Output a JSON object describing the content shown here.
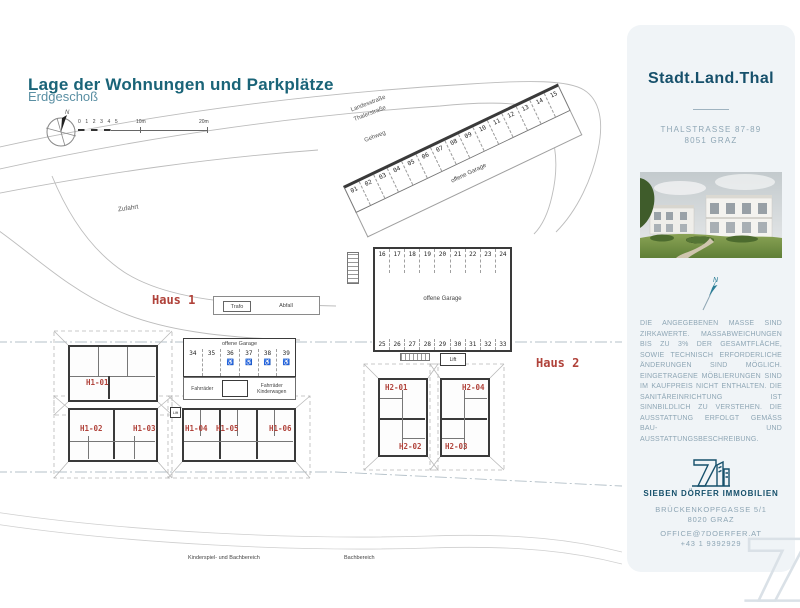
{
  "header": {
    "title": "Lage der Wohnungen und Parkplätze",
    "subtitle": "Erdgeschoß"
  },
  "map": {
    "compass_n": "N",
    "scale_ticks": "0 1 2 3 4 5",
    "scale_10": "10m",
    "scale_20": "20m",
    "road_label_1": "Landesstraße",
    "road_label_2": "Thalerstraße",
    "sidewalk_label": "Gehweg",
    "access_label": "Zufahrt",
    "wheelchair_icon": "♿",
    "strip": {
      "label": "offene Garage",
      "stalls": [
        "01",
        "02",
        "03",
        "04",
        "05",
        "06",
        "07",
        "08",
        "09",
        "10",
        "11",
        "12",
        "13",
        "14",
        "15"
      ]
    },
    "garage": {
      "label": "offene Garage",
      "top": [
        "16",
        "17",
        "18",
        "19",
        "20",
        "21",
        "22",
        "23",
        "24"
      ],
      "bottom": [
        "25",
        "26",
        "27",
        "28",
        "29",
        "30",
        "31",
        "32",
        "33"
      ],
      "lift": "Lift"
    },
    "haus1_garage": {
      "label": "offene Garage",
      "stalls": [
        {
          "n": "34",
          "acc": false
        },
        {
          "n": "35",
          "acc": false
        },
        {
          "n": "36",
          "acc": true
        },
        {
          "n": "37",
          "acc": true
        },
        {
          "n": "38",
          "acc": true
        },
        {
          "n": "39",
          "acc": true
        }
      ],
      "trafo": "Trafo",
      "waste": "Abfall",
      "bikes_left": "Fahrräder",
      "bikes_right_1": "Fahrräder",
      "bikes_right_2": "Kinderwagen",
      "lift": "Lift"
    },
    "haus1": {
      "label": "Haus 1",
      "units": [
        "H1-01",
        "H1-02",
        "H1-03",
        "H1-04",
        "H1-05",
        "H1-06"
      ]
    },
    "haus2": {
      "label": "Haus 2",
      "units": [
        "H2-01",
        "H2-02",
        "H2-03",
        "H2-04"
      ]
    },
    "area_label_left": "Kinderspiel- und Bachbereich",
    "area_label_right": "Bachbereich"
  },
  "sidebar": {
    "brand": "Stadt.Land.Thal",
    "address_line1": "THALSTRASSE 87-89",
    "address_line2": "8051 GRAZ",
    "disclaimer": "DIE ANGEGEBENEN MASSE SIND ZIRKAWERTE. MASSABWEICHUNGEN BIS ZU 3% DER GESAMTFLÄCHE, SOWIE TECHNISCH ERFORDERLICHE ÄNDERUNGEN SIND MÖGLICH. EINGETRAGENE MÖBLIERUNGEN SIND IM KAUFPREIS NICHT ENTHALTEN. DIE SANITÄREINRICHTUNG IST SINNBILDLICH ZU VERSTEHEN. DIE AUSSTATTUNG ERFOLGT GEMÄSS BAU- UND AUSSTATTUNGSBESCHREIBUNG.",
    "company": "SIEBEN DÖRFER IMMOBILIEN",
    "company_address_1": "BRÜCKENKOPFGASSE 5/1",
    "company_address_2": "8020 GRAZ",
    "email": "OFFICE@7DOERFER.AT",
    "phone": "+43 1 9392929"
  }
}
